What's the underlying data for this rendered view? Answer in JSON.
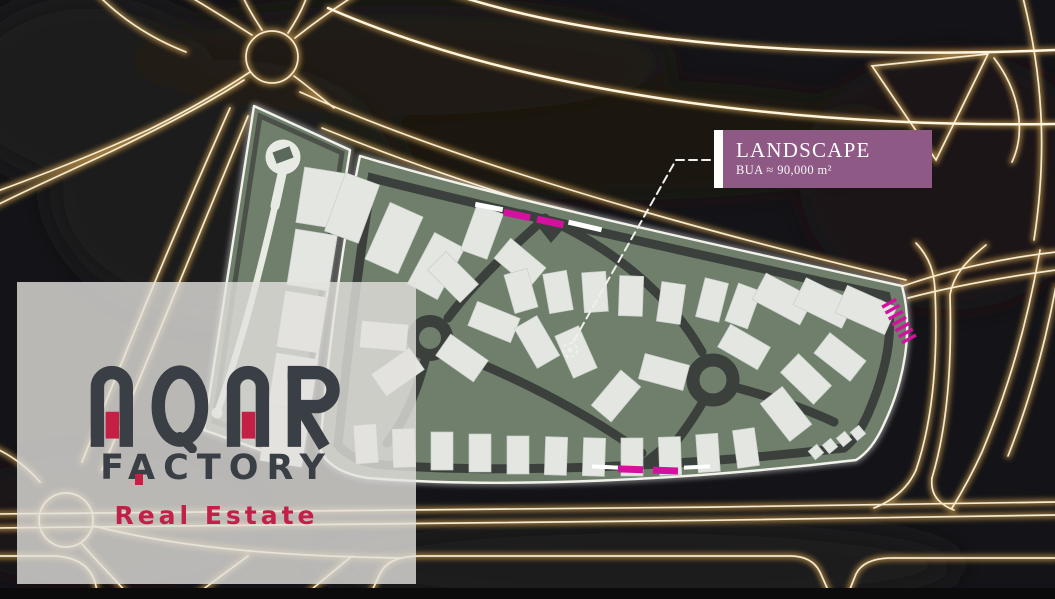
{
  "label": {
    "title": "LANDSCAPE",
    "subtitle": "BUA ≈ 90,000 m²"
  },
  "watermark": {
    "brand": "AQAR",
    "factory": "FACTORY",
    "tagline": "Real Estate"
  },
  "colors": {
    "background": "#141418",
    "road_glow_core": "#f3ead2",
    "road_glow_halo": "#b98f47",
    "site_green": "#6f7f6c",
    "building": "#e3e6e1",
    "road_dark": "#3b403c",
    "boundary_white": "#f2f2ea",
    "gate_magenta": "#d4119e",
    "label_purple": "#8e5a85",
    "brand_charcoal": "#3a3f45",
    "brand_red": "#c41f45",
    "tagline_red": "#c22048"
  }
}
